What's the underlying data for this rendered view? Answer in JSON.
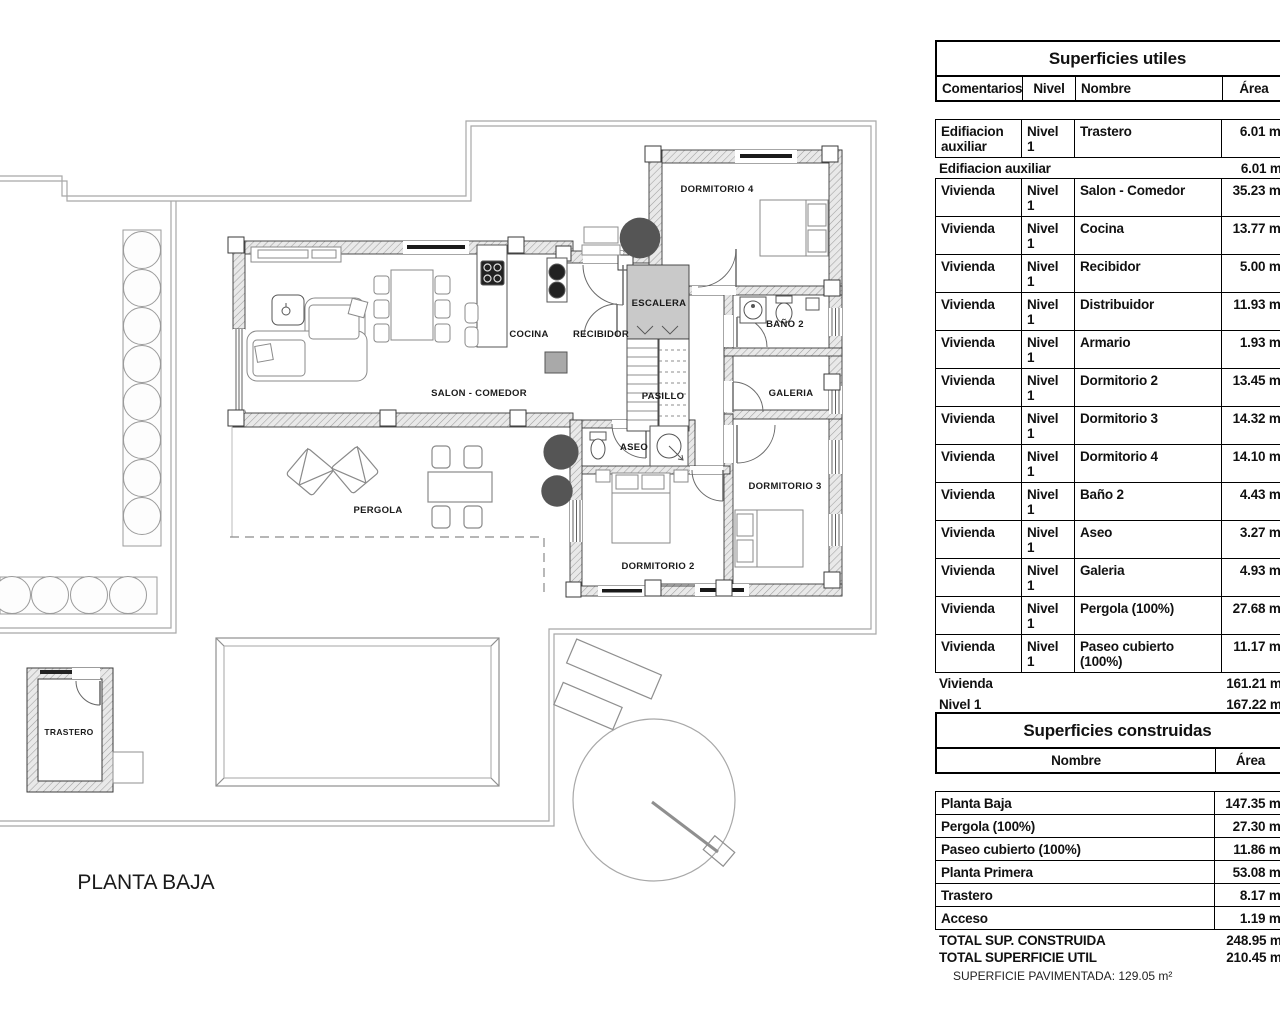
{
  "plan": {
    "title": "PLANTA BAJA",
    "labels": {
      "dormitorio4": "DORMITORIO 4",
      "escalera": "ESCALERA",
      "banio2": "BAÑO 2",
      "cocina": "COCINA",
      "recibidor": "RECIBIDOR",
      "salon": "SALON - COMEDOR",
      "pasillo": "PASILLO",
      "galeria": "GALERIA",
      "aseo": "ASEO",
      "dormitorio3": "DORMITORIO 3",
      "dormitorio2": "DORMITORIO 2",
      "pergola": "PERGOLA",
      "trastero": "TRASTERO"
    }
  },
  "tables": {
    "utiles": {
      "title": "Superficies utiles",
      "headers": {
        "comentarios": "Comentarios",
        "nivel": "Nivel",
        "nombre": "Nombre",
        "area": "Área"
      },
      "rows": [
        {
          "type": "data",
          "tall": true,
          "c": "Edifiacion auxiliar",
          "n": "Nivel 1",
          "nom": "Trastero",
          "a": "6.01 m²"
        },
        {
          "type": "sum",
          "lab": "Edifiacion auxiliar",
          "a": "6.01 m²"
        },
        {
          "type": "data",
          "c": "Vivienda",
          "n": "Nivel 1",
          "nom": "Salon - Comedor",
          "a": "35.23 m²"
        },
        {
          "type": "data",
          "c": "Vivienda",
          "n": "Nivel 1",
          "nom": "Cocina",
          "a": "13.77 m²"
        },
        {
          "type": "data",
          "c": "Vivienda",
          "n": "Nivel 1",
          "nom": "Recibidor",
          "a": "5.00 m²"
        },
        {
          "type": "data",
          "c": "Vivienda",
          "n": "Nivel 1",
          "nom": "Distribuidor",
          "a": "11.93 m²"
        },
        {
          "type": "data",
          "c": "Vivienda",
          "n": "Nivel 1",
          "nom": "Armario",
          "a": "1.93 m²"
        },
        {
          "type": "data",
          "c": "Vivienda",
          "n": "Nivel 1",
          "nom": "Dormitorio 2",
          "a": "13.45 m²"
        },
        {
          "type": "data",
          "c": "Vivienda",
          "n": "Nivel 1",
          "nom": "Dormitorio 3",
          "a": "14.32 m²"
        },
        {
          "type": "data",
          "c": "Vivienda",
          "n": "Nivel 1",
          "nom": "Dormitorio 4",
          "a": "14.10 m²"
        },
        {
          "type": "data",
          "c": "Vivienda",
          "n": "Nivel 1",
          "nom": "Baño 2",
          "a": "4.43 m²"
        },
        {
          "type": "data",
          "c": "Vivienda",
          "n": "Nivel 1",
          "nom": "Aseo",
          "a": "3.27 m²"
        },
        {
          "type": "data",
          "c": "Vivienda",
          "n": "Nivel 1",
          "nom": "Galeria",
          "a": "4.93 m²"
        },
        {
          "type": "data",
          "c": "Vivienda",
          "n": "Nivel 1",
          "nom": "Pergola (100%)",
          "a": "27.68 m²"
        },
        {
          "type": "data",
          "c": "Vivienda",
          "n": "Nivel 1",
          "nom": "Paseo cubierto (100%)",
          "a": "11.17 m²"
        },
        {
          "type": "sum",
          "lab": "Vivienda",
          "a": "161.21 m²"
        },
        {
          "type": "sum",
          "lab": "Nivel 1",
          "a": "167.22 m²"
        },
        {
          "type": "data",
          "c": "Vivienda",
          "n": "Nivel 2",
          "nom": "Descansillo",
          "a": "2.17 m²"
        },
        {
          "type": "data",
          "c": "Vivienda",
          "n": "Nivel 2",
          "nom": "Vestidor",
          "a": "7.77 m²"
        },
        {
          "type": "data",
          "c": "Vivienda",
          "n": "Nivel 2",
          "nom": "Baño 1",
          "a": "7.93 m²"
        },
        {
          "type": "data",
          "c": "Vivienda",
          "n": "Nivel 2",
          "nom": "Dormitorio 1",
          "a": "20.21 m²"
        },
        {
          "type": "data",
          "c": "Vivienda",
          "n": "Nivel 2",
          "nom": "Escalera",
          "a": "5.15 m²"
        },
        {
          "type": "sum",
          "lab": "Vivienda",
          "a": "43.23 m²"
        },
        {
          "type": "sum",
          "lab": "Nivel 2",
          "a": "43.23 m²"
        },
        {
          "type": "total",
          "lab": "TOTAL SUPERFICIE UTIL",
          "a": "210.45 m²"
        }
      ]
    },
    "construidas": {
      "title": "Superficies construidas",
      "headers": {
        "nombre": "Nombre",
        "area": "Área"
      },
      "rows": [
        {
          "type": "data",
          "nom": "Planta Baja",
          "a": "147.35 m²"
        },
        {
          "type": "data",
          "nom": "Pergola (100%)",
          "a": "27.30 m²"
        },
        {
          "type": "data",
          "nom": "Paseo cubierto (100%)",
          "a": "11.86 m²"
        },
        {
          "type": "data",
          "nom": "Planta Primera",
          "a": "53.08 m²"
        },
        {
          "type": "data",
          "nom": "Trastero",
          "a": "8.17 m²"
        },
        {
          "type": "data",
          "nom": "Acceso",
          "a": "1.19 m²"
        },
        {
          "type": "total",
          "lab": "TOTAL SUP. CONSTRUIDA",
          "a": "248.95 m²"
        }
      ]
    },
    "note": "SUPERFICIE PAVIMENTADA: 129.05 m²"
  }
}
